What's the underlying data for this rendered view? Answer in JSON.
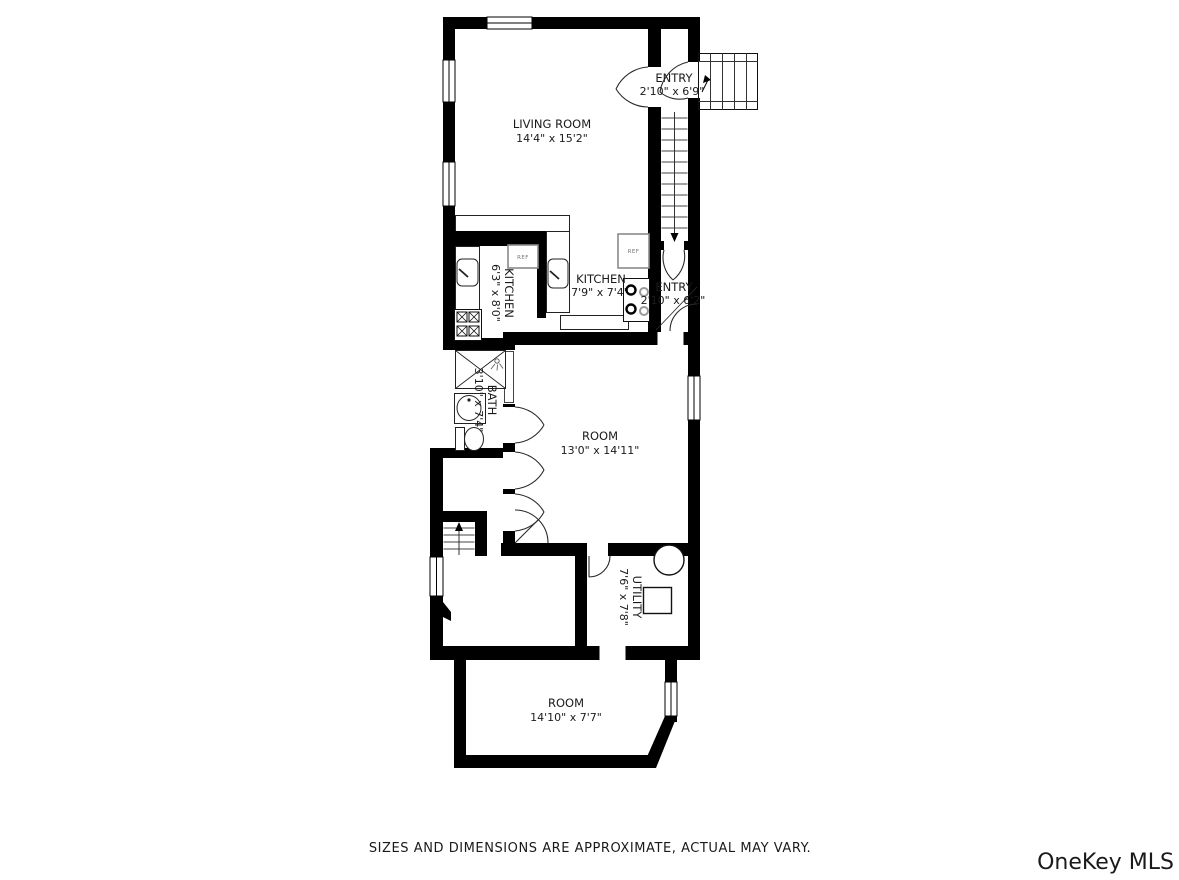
{
  "floorplan": {
    "rooms": [
      {
        "id": "living-room",
        "name": "LIVING ROOM",
        "dims": "14'4\" x 15'2\""
      },
      {
        "id": "entry-upper",
        "name": "ENTRY",
        "dims": "2'10\" x 6'9\""
      },
      {
        "id": "kitchen-side",
        "name": "KITCHEN",
        "dims": "6'3\" x 8'0\""
      },
      {
        "id": "kitchen-main",
        "name": "KITCHEN",
        "dims": "7'9\" x 7'4\""
      },
      {
        "id": "entry-lower",
        "name": "ENTRY",
        "dims": "2'10\" x 6'2\""
      },
      {
        "id": "bath",
        "name": "BATH",
        "dims": "3'10\" x 7'4\""
      },
      {
        "id": "room-middle",
        "name": "ROOM",
        "dims": "13'0\" x 14'11\""
      },
      {
        "id": "utility",
        "name": "UTILITY",
        "dims": "7'6\" x 7'8\""
      },
      {
        "id": "room-bottom",
        "name": "ROOM",
        "dims": "14'10\" x 7'7\""
      }
    ],
    "appliance_labels": {
      "fridge": "REF"
    },
    "colors": {
      "wall": "#000000",
      "label_text": "#1a1a1a"
    }
  },
  "footer": {
    "disclaimer": "SIZES AND DIMENSIONS ARE APPROXIMATE, ACTUAL MAY VARY.",
    "color": "#b3b3b3"
  },
  "watermark": {
    "text": "OneKey MLS",
    "color": "#a6a6a6"
  }
}
